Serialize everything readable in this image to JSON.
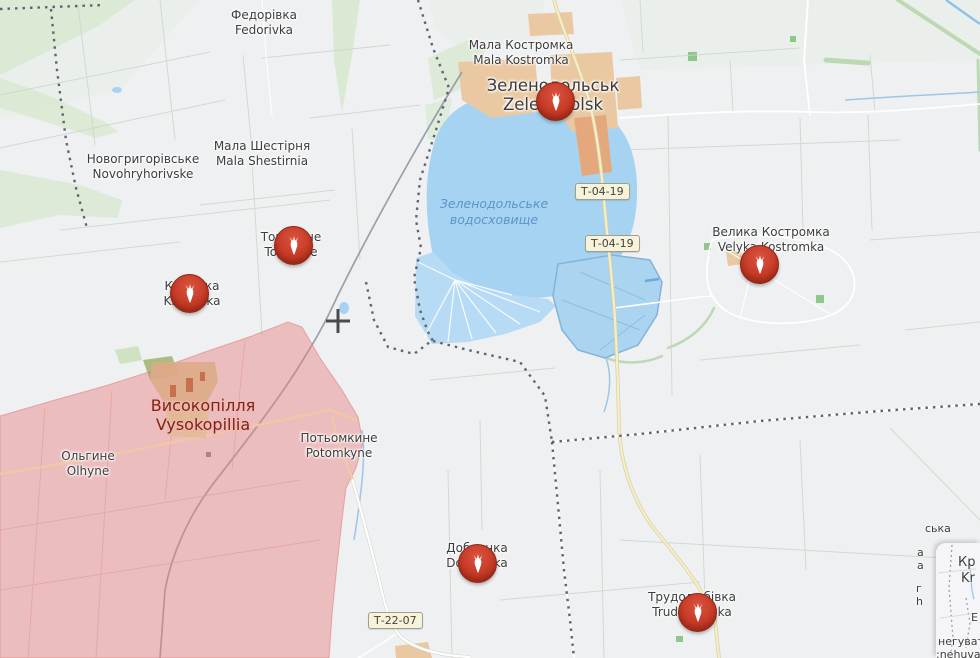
{
  "app": {
    "type": "interactive-war-map",
    "language": "uk/en"
  },
  "colors": {
    "map_background": "#eef0f2",
    "water": "#a6d3f2",
    "water_ponds": "#b7dbf4",
    "water_label": "#5f93c8",
    "vegetation": "#d9e9d3",
    "urban": "#eac9a2",
    "urban_accent": "#e5a87c",
    "occupied_zone": "#e87e7e",
    "boundary_dash": "#63636f",
    "railway": "#98a0ab",
    "main_road": "#f6efc6",
    "shield_background": "#f7f3da",
    "marker_red": "#c23722",
    "place_label": "#3d3d3d",
    "occupied_city_label": "#7d241a"
  },
  "places": [
    {
      "id": "fedorivka",
      "uk": "Федорівка",
      "en": "Fedorivka"
    },
    {
      "id": "mala-kostromka",
      "uk": "Мала Костромка",
      "en": "Mala Kostromka"
    },
    {
      "id": "zelenodolsk",
      "uk": "Зеленодольськ",
      "en": "Zelenodolsk"
    },
    {
      "id": "mala-shestirnia",
      "uk": "Мала Шестірня",
      "en": "Mala Shestirnia"
    },
    {
      "id": "novohryhorivske",
      "uk": "Новогригорівське",
      "en": "Novohryhorivske"
    },
    {
      "id": "topolyne",
      "uk": "Тополине",
      "en": "Topolyne"
    },
    {
      "id": "kniazivka",
      "uk": "Князівка",
      "en": "Kniazivka"
    },
    {
      "id": "velyka-kostromka",
      "uk": "Велика Костромка",
      "en": "Velyka Kostromka"
    },
    {
      "id": "vysokopillia",
      "uk": "Високопілля",
      "en": "Vysokopillia"
    },
    {
      "id": "olhyne",
      "uk": "Ольгине",
      "en": "Olhyne"
    },
    {
      "id": "potomkyne",
      "uk": "Потьомкине",
      "en": "Potomkyne"
    },
    {
      "id": "dobrianka",
      "uk": "Добрянка",
      "en": "Dobrianka"
    },
    {
      "id": "trudoliubivka",
      "uk": "Трудолюбівка",
      "en": "Trudoliubivka"
    }
  ],
  "water_label": {
    "line1": "Зеленодольське",
    "line2": "водосховище"
  },
  "road_shields": [
    {
      "label": "Т-04-19"
    },
    {
      "label": "Т-04-19"
    },
    {
      "label": "Т-22-07"
    }
  ],
  "markers": [
    {
      "place_id": "zelenodolsk",
      "icon": "bomb-icon"
    },
    {
      "place_id": "topolyne",
      "icon": "bomb-icon"
    },
    {
      "place_id": "kniazivka",
      "icon": "bomb-icon"
    },
    {
      "place_id": "velyka-kostromka",
      "icon": "bomb-icon"
    },
    {
      "place_id": "dobrianka",
      "icon": "bomb-icon"
    },
    {
      "place_id": "trudoliubivka",
      "icon": "bomb-icon"
    }
  ],
  "minimap": {
    "fragments": {
      "city_uk": "Кр",
      "city_en": "Kr",
      "letter": "Е",
      "bottom_uk": "негуват",
      "bottom_en": ":nehuvat"
    }
  },
  "map_edge_fragments": {
    "top": "ська",
    "col1a": "а",
    "col1b": "а",
    "col2a": "г",
    "col2b": "h"
  }
}
